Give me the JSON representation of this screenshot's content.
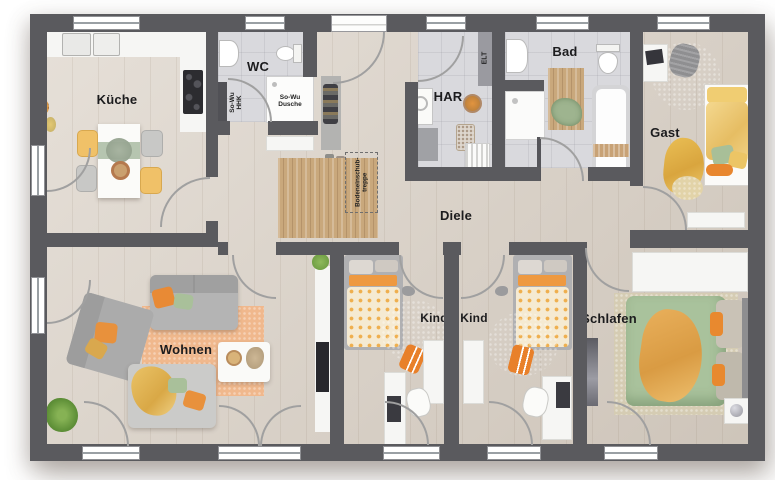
{
  "plan_title": "Erdgeschoss Grundriss",
  "rooms": [
    {
      "id": "kueche",
      "label": "Küche"
    },
    {
      "id": "wc",
      "label": "WC"
    },
    {
      "id": "har",
      "label": "HAR"
    },
    {
      "id": "bad",
      "label": "Bad"
    },
    {
      "id": "gast",
      "label": "Gast"
    },
    {
      "id": "diele",
      "label": "Diele"
    },
    {
      "id": "wohnen",
      "label": "Wohnen"
    },
    {
      "id": "kind1",
      "label": "Kind"
    },
    {
      "id": "kind2",
      "label": "Kind"
    },
    {
      "id": "schlafen",
      "label": "Schlafen"
    }
  ],
  "annotations": {
    "elt": "ELT",
    "so_wu_hhk_1": "So-Wu",
    "so_wu_hhk_2": "HHK",
    "so_wu_dusche_1": "So-Wu",
    "so_wu_dusche_2": "Dusche",
    "treppe_1": "Bodeneinschub-",
    "treppe_2": "treppe"
  },
  "colors": {
    "wall": "#5a5a5e",
    "wood_floor": "#dbd2c7",
    "tile_floor": "#d9d9dd",
    "attic_mat": "#c9a87c",
    "accent_orange": "#e8913c",
    "accent_green": "#a9c09a",
    "accent_yellow": "#eec467",
    "rug_orange": "#f0b88d",
    "rug_green": "#a3bc8e",
    "window_frame": "#9aa0a4"
  }
}
